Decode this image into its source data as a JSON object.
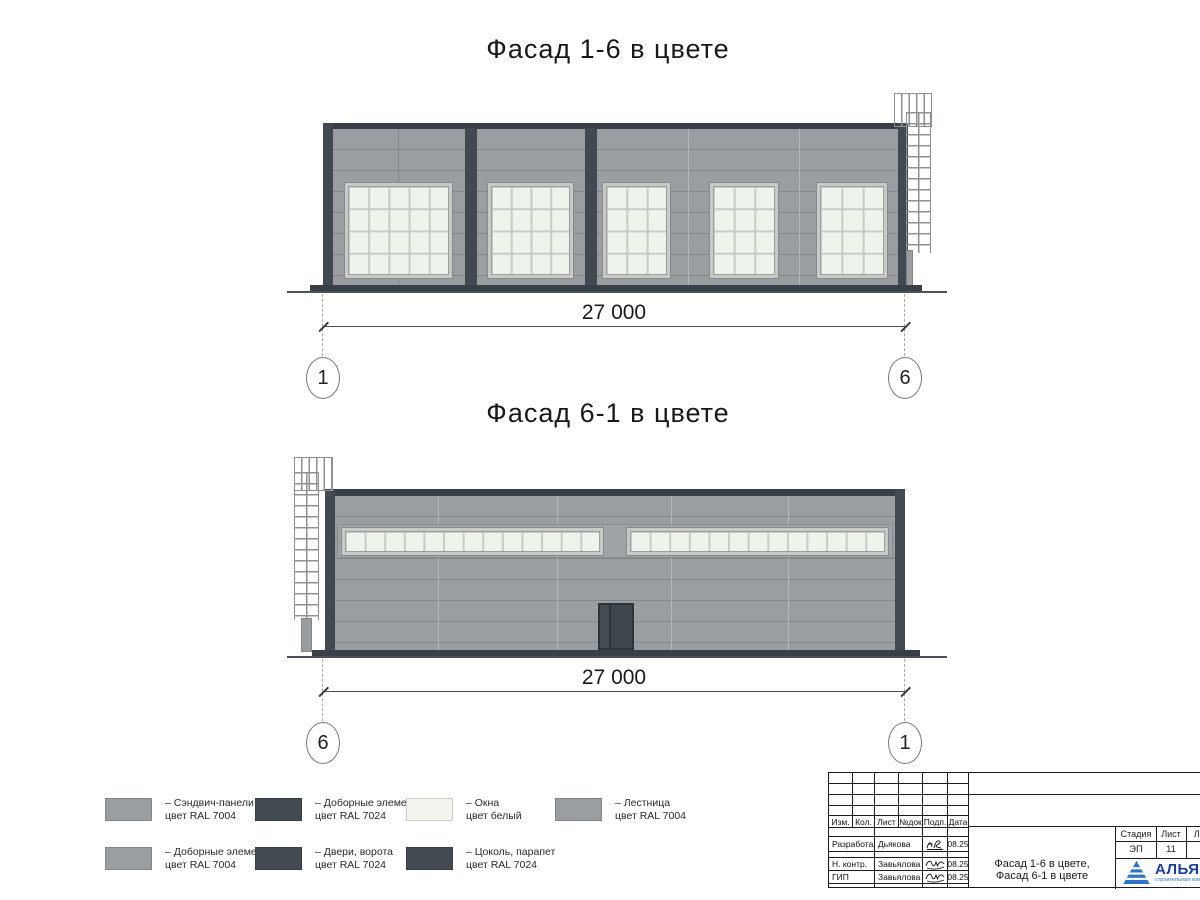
{
  "facade1": {
    "title": "Фасад 1-6 в цвете",
    "dimension": "27 000",
    "axis_left": "1",
    "axis_right": "6"
  },
  "facade2": {
    "title": "Фасад 6-1 в цвете",
    "dimension": "27 000",
    "axis_left": "6",
    "axis_right": "1"
  },
  "colors": {
    "wall_ral7004": "#9b9ea1",
    "dark_ral7024": "#434a52",
    "window_white": "#f2f3ec",
    "window_pane": "#eef3ec",
    "logo_blue": "#2f74c4",
    "logo_text_blue": "#1d3e9b"
  },
  "legend": {
    "rows": [
      [
        {
          "sw": "#9b9ea1",
          "l1": "– Сэндвич-панели",
          "l2": "цвет RAL 7004"
        },
        {
          "sw": "#434a52",
          "l1": "– Доборные элементы",
          "l2": "цвет RAL 7024"
        },
        {
          "sw": "#f2f3ec",
          "l1": "– Окна",
          "l2": "цвет белый"
        },
        {
          "sw": "#9b9ea1",
          "l1": "– Лестница",
          "l2": "цвет RAL 7004"
        }
      ],
      [
        {
          "sw": "#9b9ea1",
          "l1": "– Доборные элементы",
          "l2": "цвет RAL 7004"
        },
        {
          "sw": "#434a52",
          "l1": "– Двери, ворота",
          "l2": "цвет RAL 7024"
        },
        {
          "sw": "#434a52",
          "l1": "– Цоколь, парапет",
          "l2": "цвет RAL 7024"
        }
      ]
    ]
  },
  "titleblock": {
    "rev_headers": [
      "Изм.",
      "Кол.",
      "Лист",
      "№док",
      "Подп.",
      "Дата"
    ],
    "signoff": [
      {
        "role": "Разработал",
        "name": "Дьякова",
        "date": "08.25"
      },
      {
        "role": "Н. контр.",
        "name": "Завьялова",
        "date": "08.25"
      },
      {
        "role": "ГИП",
        "name": "Завьялова",
        "date": "08.25"
      }
    ],
    "stage_header": "Стадия",
    "sheet_header": "Лист",
    "sheets_header": "Листов",
    "stage": "ЭП",
    "sheet": "11",
    "sheets": "2",
    "doc_title_line1": "Фасад 1-6 в цвете,",
    "doc_title_line2": "Фасад 6-1 в цвете",
    "company": "АЛЬЯНС",
    "tagline": "строительная компания"
  }
}
